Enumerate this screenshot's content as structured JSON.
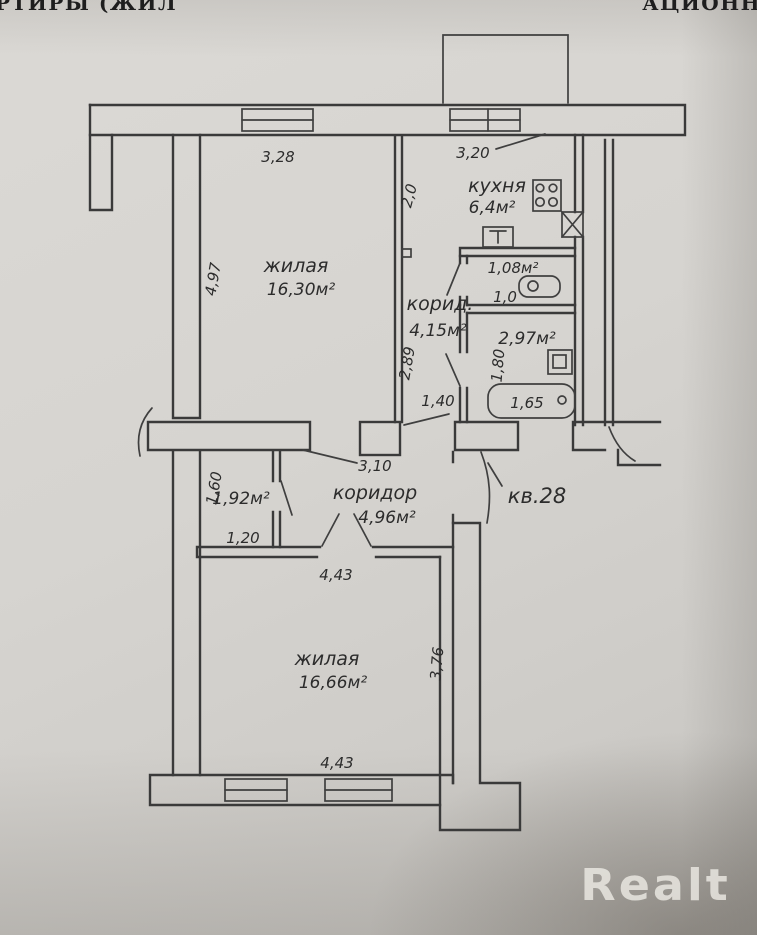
{
  "header": {
    "left": "РТИРЫ (ЖИЛ",
    "right": "АЦИОНН"
  },
  "watermark": {
    "text": "Realt"
  },
  "plan": {
    "apartment": "кв.28",
    "rooms": {
      "living1": {
        "name": "жилая",
        "area": "16,30м²"
      },
      "kitchen": {
        "name": "кухня",
        "area": "6,4м²"
      },
      "hall_small": {
        "name": "корид.",
        "area": "4,15м²"
      },
      "hall_main": {
        "name": "коридор",
        "area": "4,96м²"
      },
      "living2": {
        "name": "жилая",
        "area": "16,66м²"
      },
      "wc": {
        "area": "1,08м²"
      },
      "bathroom": {
        "area": "2,97м²"
      },
      "closet": {
        "area": "1,92м²"
      }
    },
    "dims": {
      "living1_width": "3,28",
      "kitchen_width": "3,20",
      "kitchen_depth": "2,0",
      "living1_depth": "4,97",
      "hall_wall": "2,89",
      "opening": "1,40",
      "wc_depth": "1,0",
      "bath_depth": "1,80",
      "tub_length": "1,65",
      "hall_width": "3,10",
      "closet_depth": "1,60",
      "closet_width": "1,20",
      "living2_width_top": "4,43",
      "living2_depth": "3,76",
      "living2_width_bottom": "4,43"
    }
  }
}
